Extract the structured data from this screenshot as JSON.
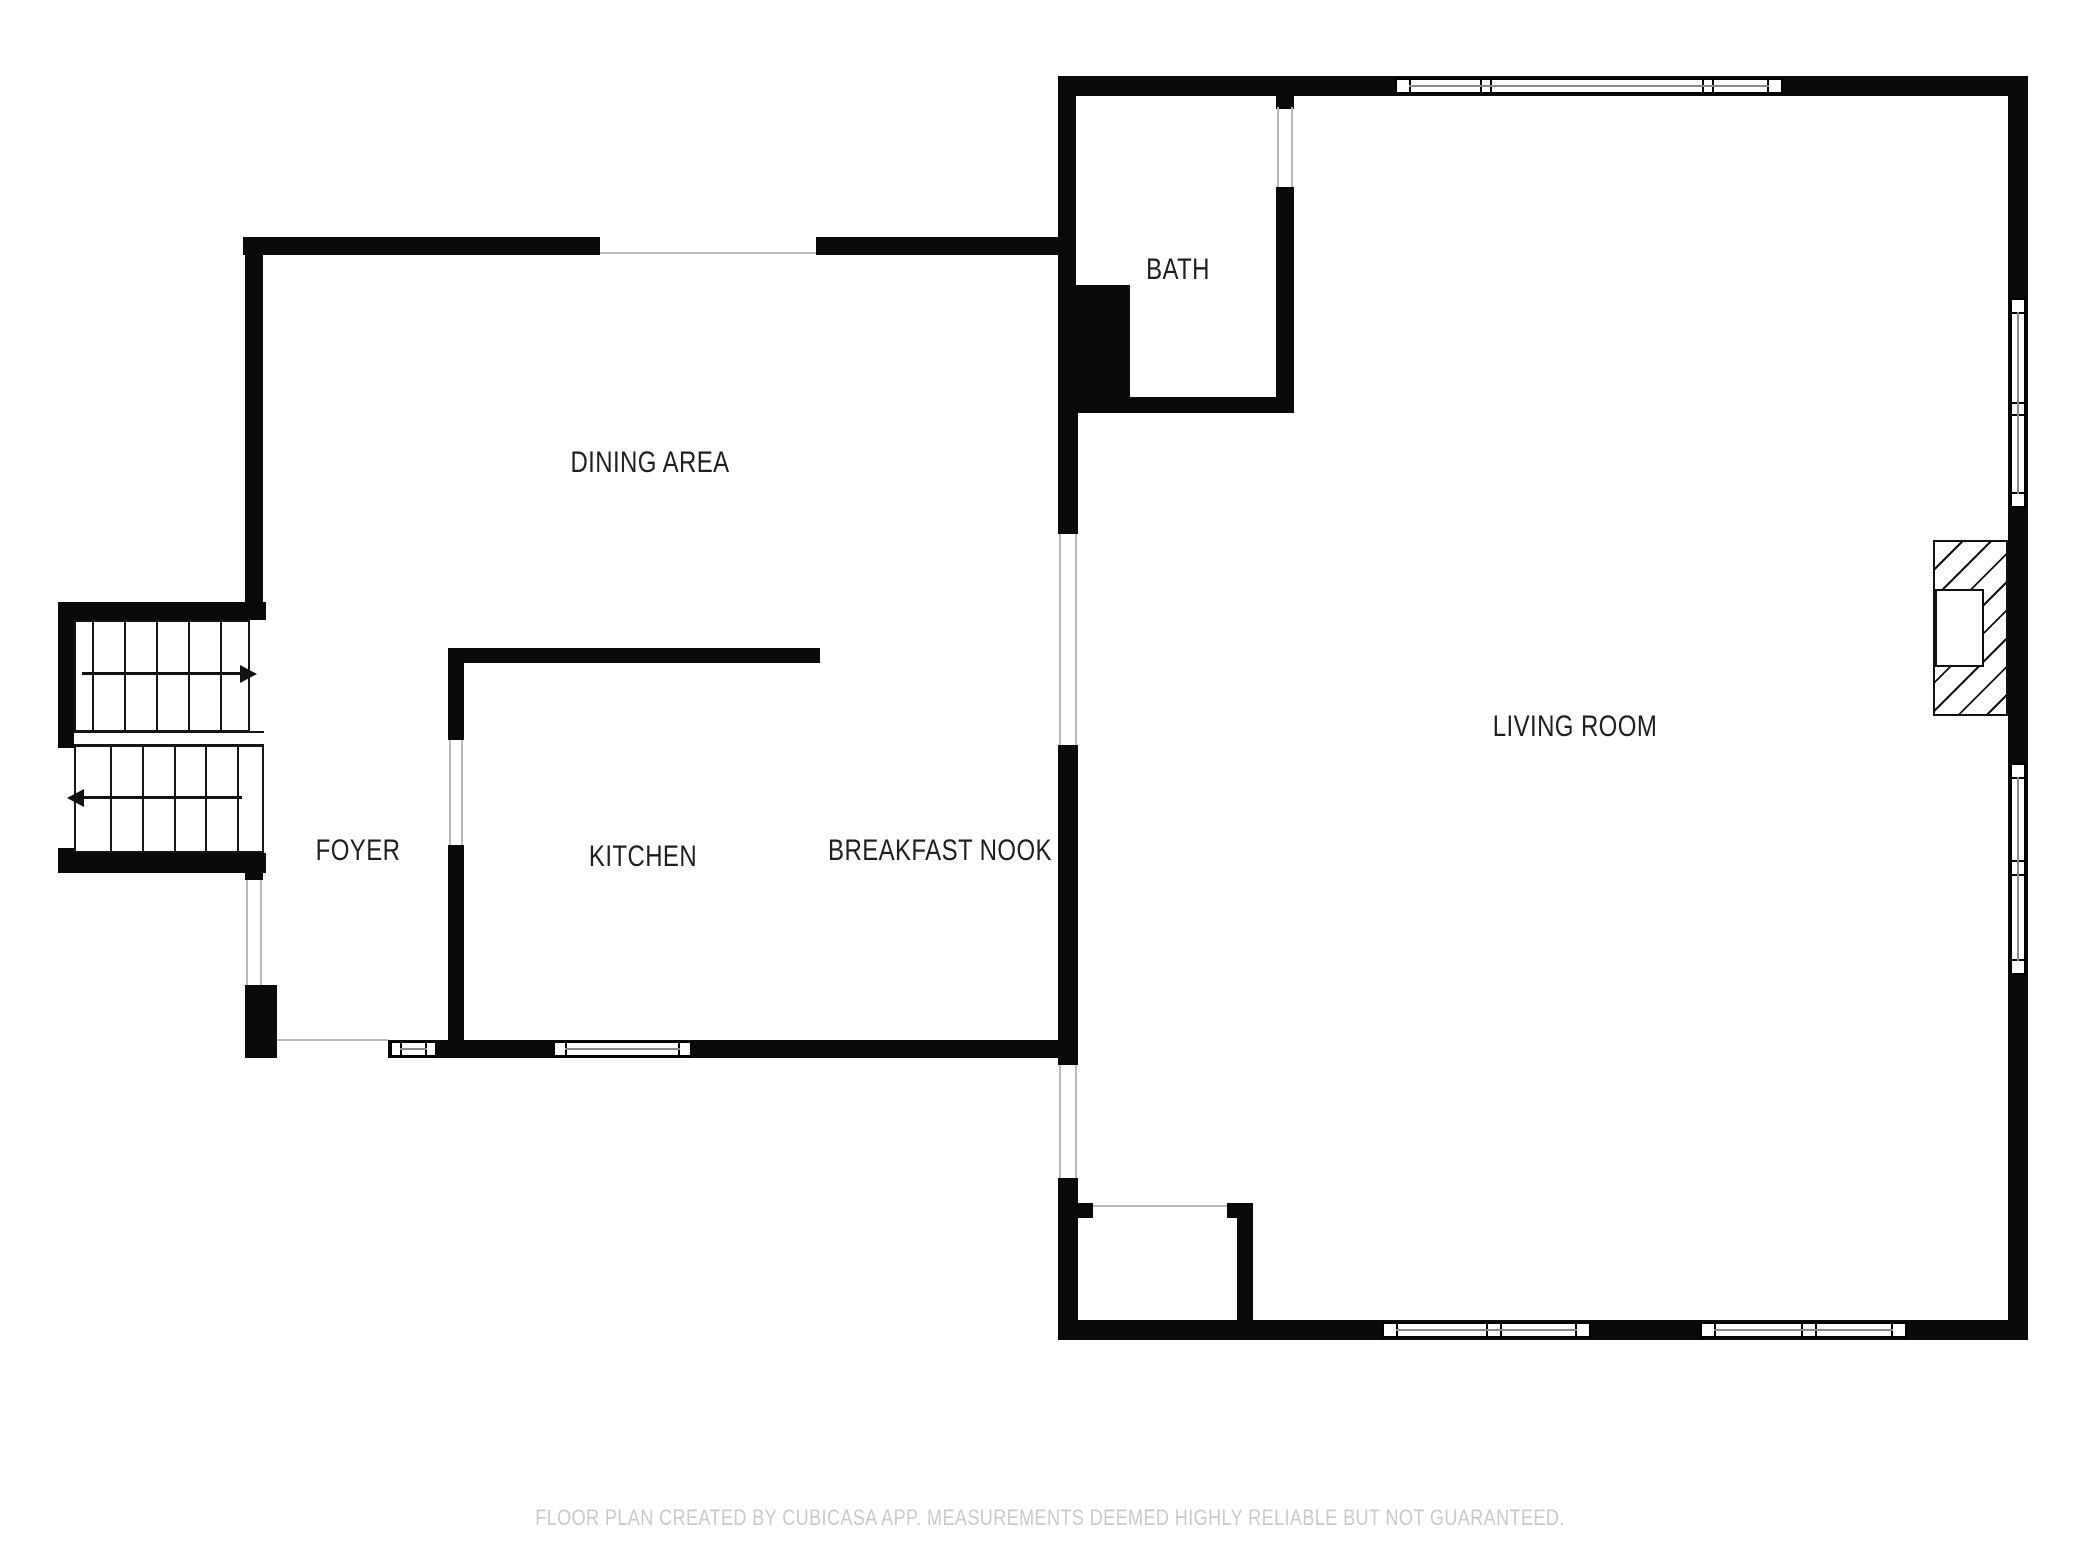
{
  "rooms": {
    "dining": {
      "label": "DINING AREA"
    },
    "bath": {
      "label": "BATH"
    },
    "living": {
      "label": "LIVING ROOM"
    },
    "foyer": {
      "label": "FOYER"
    },
    "kitchen": {
      "label": "KITCHEN"
    },
    "breakfast_nook": {
      "label": "BREAKFAST NOOK"
    }
  },
  "footer": {
    "text": "FLOOR PLAN CREATED BY CUBICASA APP. MEASUREMENTS DEEMED HIGHLY RELIABLE BUT NOT GUARANTEED."
  },
  "colors": {
    "background": "#ffffff",
    "wall": "#0a0a0a",
    "label_text": "#1f1f1f",
    "footer_text": "#c9c9c9",
    "opening_line": "#b9b9b9",
    "window_center_line": "#8a8a8a"
  }
}
